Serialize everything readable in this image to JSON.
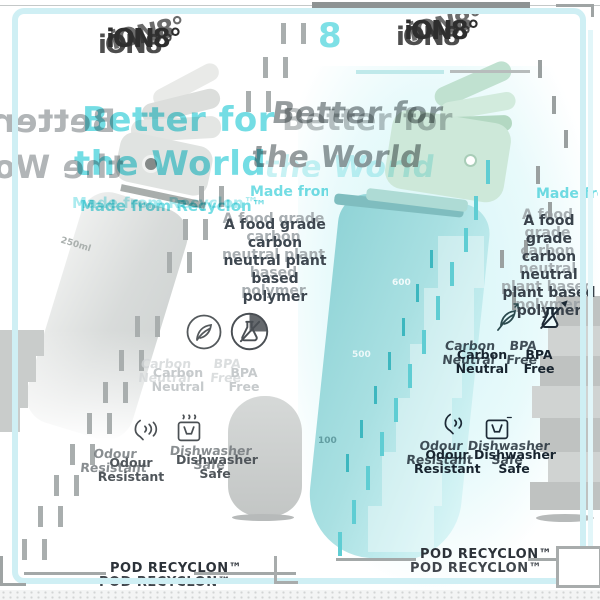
{
  "poster": {
    "brand_logo": "iON8°",
    "badge_number": "8"
  },
  "shared": {
    "headline_line1": "Better for",
    "headline_line2": "the World",
    "subheadline": "Made from Recyclon™",
    "body_line1": "A food grade carbon",
    "body_line2": "neutral plant based",
    "body_line3": "polymer",
    "footer": "POD RECYCLON™",
    "features": [
      {
        "icon": "leaf-icon",
        "label_line1": "Carbon",
        "label_line2": "Neutral"
      },
      {
        "icon": "flask-icon",
        "label_line1": "BPA",
        "label_line2": "Free"
      },
      {
        "icon": "odour-icon",
        "label_line1": "Odour",
        "label_line2": "Resistant"
      },
      {
        "icon": "dishwasher-icon",
        "label_line1": "Dishwasher",
        "label_line2": "Safe"
      }
    ]
  },
  "left_panel": {
    "scale_mark": "250ml"
  },
  "right_panel": {
    "scale_mark_600": "600",
    "scale_mark_500": "500",
    "scale_mark_100": "100"
  },
  "colors": {
    "teal_accent": "#74dde4",
    "frame_cyan": "#cfeff4",
    "text_dark": "#3e4750",
    "navy": "#1a2532",
    "ghost_gray": "#9aa1a5",
    "bottle_gray": "#d6d9d8",
    "bottle_teal": "#a9e0e2",
    "cap_mint": "#cde8d9"
  }
}
